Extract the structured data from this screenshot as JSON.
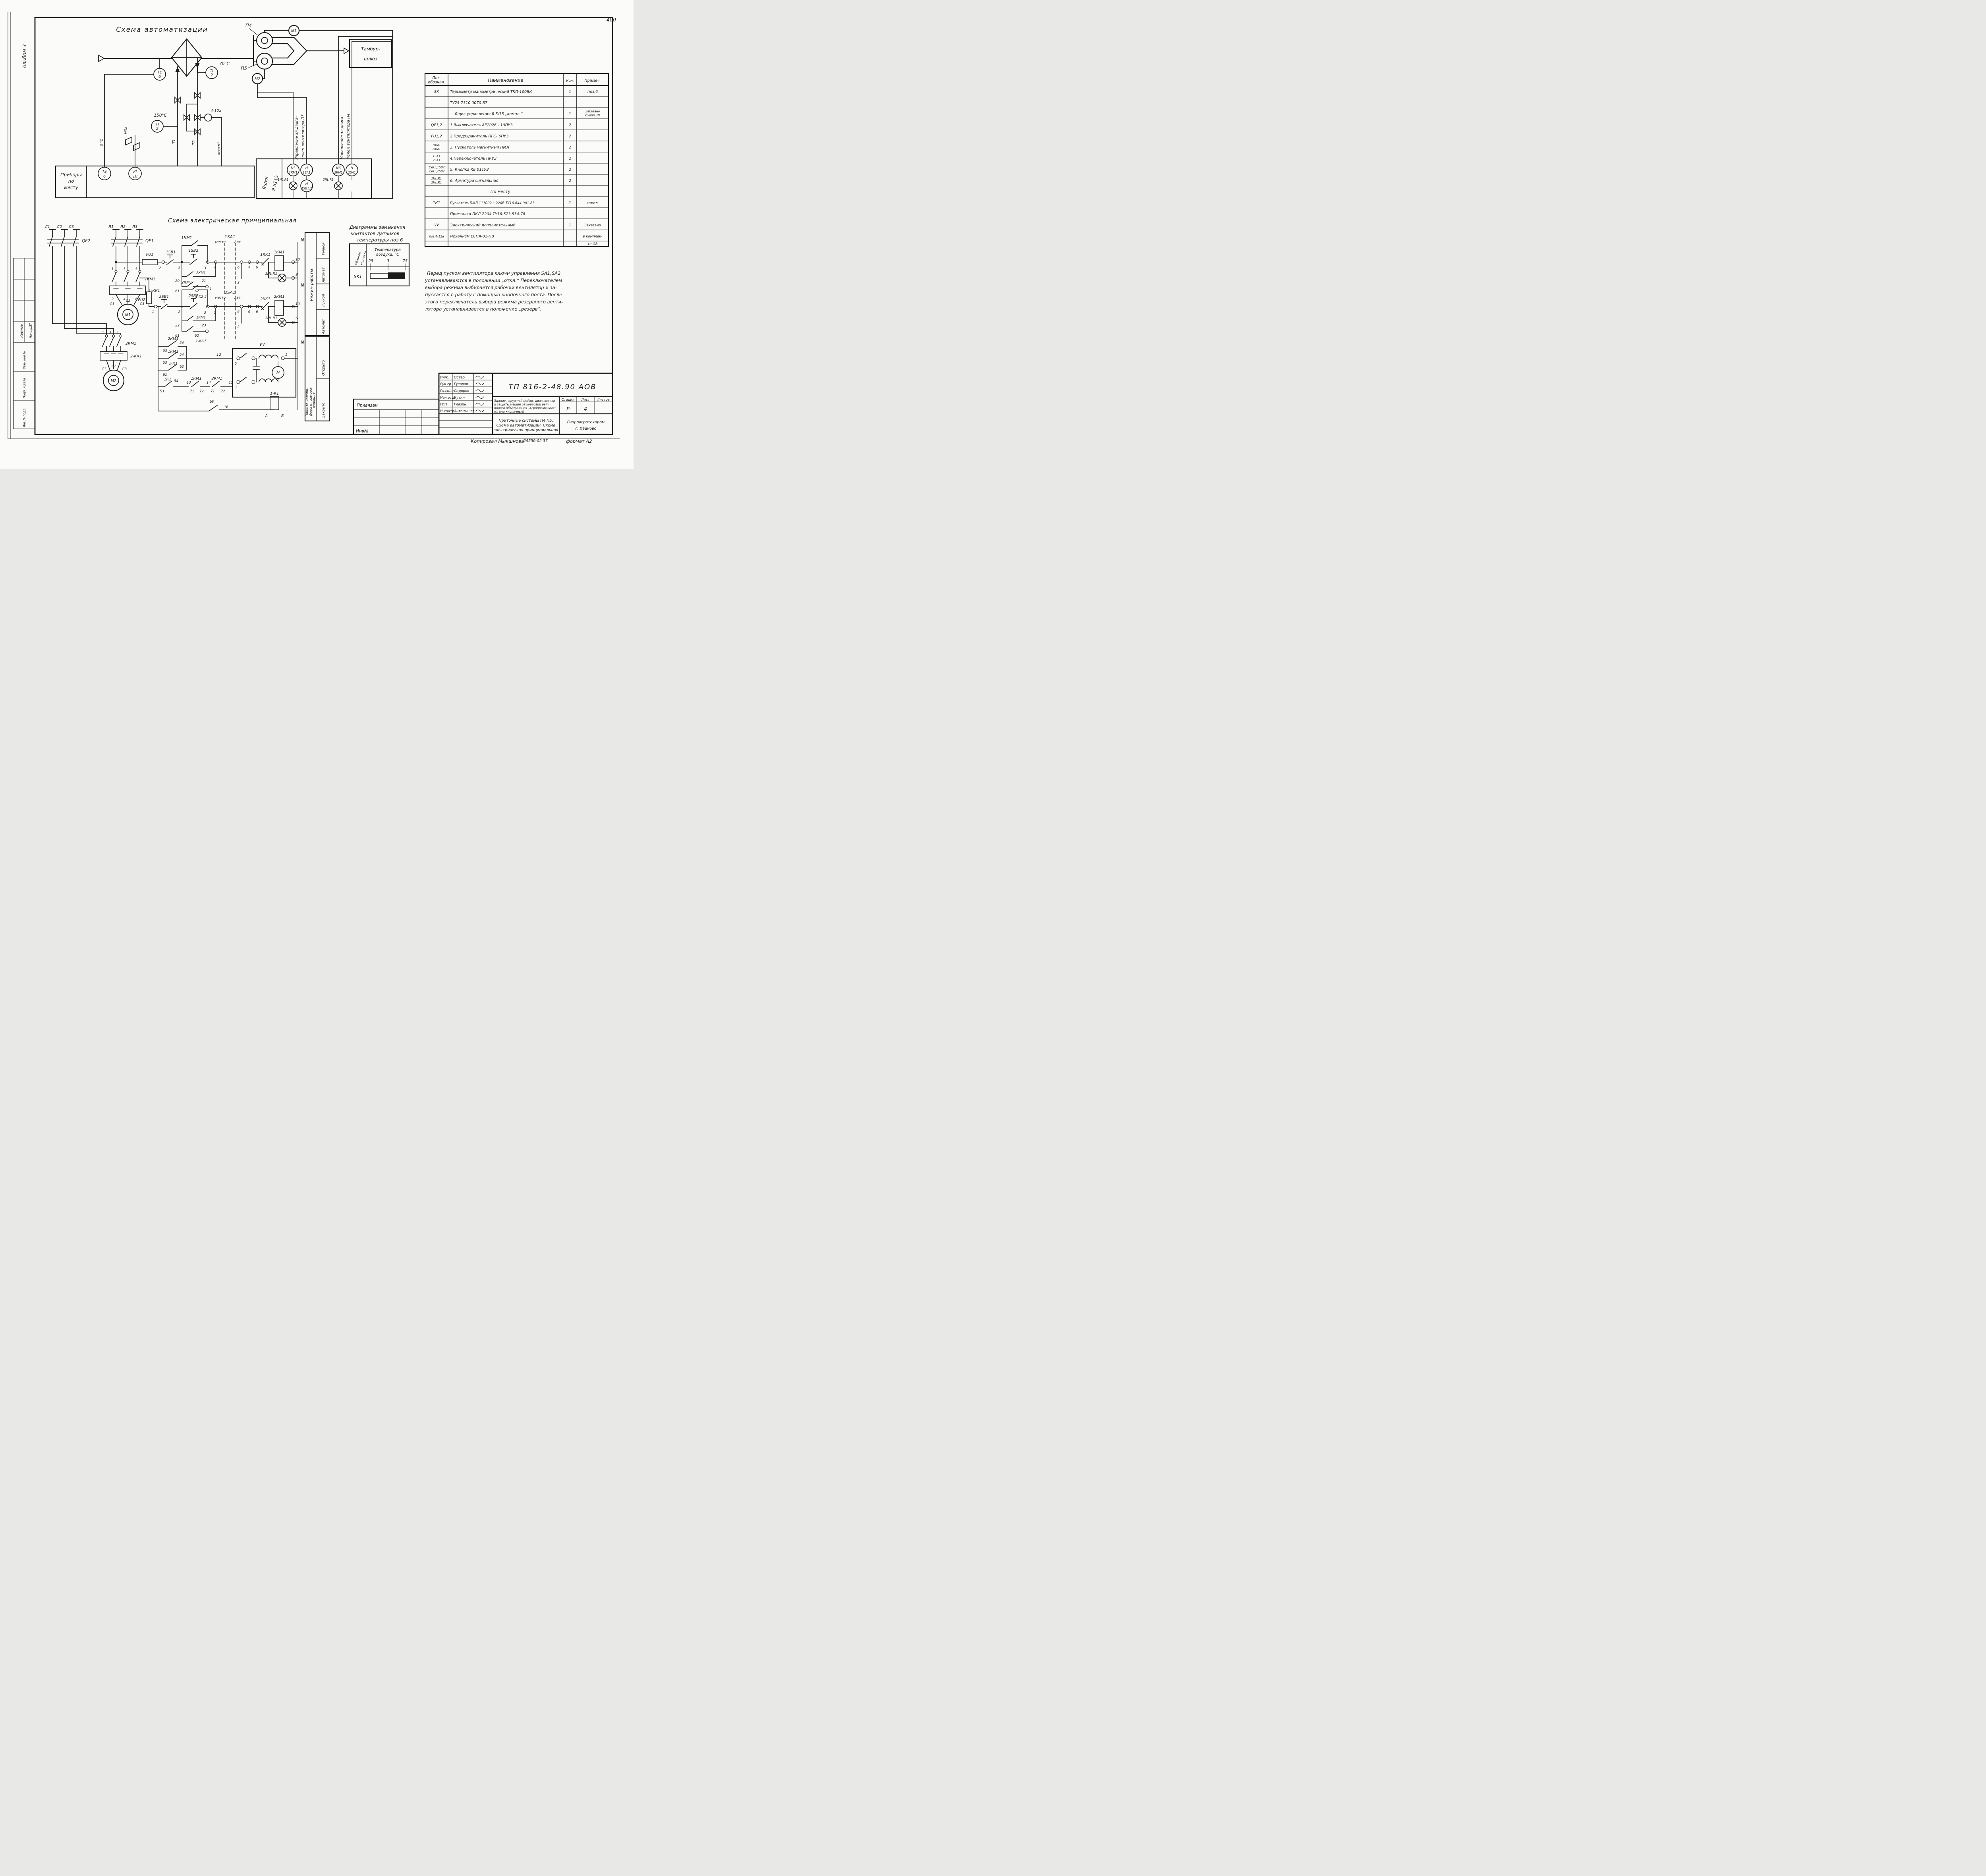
{
  "corner_mark": "400",
  "margin": {
    "album": "Альбом 3",
    "role": "Нач.пр.ЗТ",
    "sign": "Крылов",
    "rows": [
      "Взам.инв.№",
      "Подп. и дата",
      "Инв.№ подл."
    ]
  },
  "auto": {
    "title": "Схема автоматизации",
    "p4": "П4",
    "p5": "П5",
    "m1": "М1",
    "m2": "М2",
    "tambur1": "Тамбур-",
    "tambur2": "шлюз",
    "te": "ТЕ",
    "te_n": "6",
    "ti": "ТI",
    "ti_n": "2",
    "t70": "70°С",
    "t150": "150°С",
    "act": "4-12а",
    "t1": "Т1",
    "t2": "Т2",
    "mpa": "МПа",
    "kgs": "кгс/см²",
    "deg": "3 °С",
    "prib1": "Приборы",
    "prib2": "по",
    "prib3": "месту",
    "box1": "Ящик",
    "box2": "Я 5115",
    "ts": "ТS",
    "ts_n": "6",
    "pi": "РI",
    "pi_n": "10",
    "ns": "NS",
    "h": "Н",
    "km1": "1КМ1",
    "sa1": "1SA1",
    "hl1": "1HL.R1",
    "sb1": "1SB1,2",
    "km2": "2КМ1",
    "sa2": "2SA1",
    "hl2": "2HL.R1",
    "sb2": "2SB1,2",
    "upr1a": "Управление эл.двига-",
    "upr1b": "телем вентилятора П5",
    "upr2a": "Управление эл.двига-",
    "upr2b": "телем вентилятора П4"
  },
  "elec": {
    "title": "Схема электрическая принципиальная",
    "l1": "Л1",
    "l2": "Л2",
    "l3": "Л3",
    "qf1": "QF1",
    "qf2": "QF2",
    "fu1": "FU1",
    "fu2": "FU2",
    "km1": "1КМ1",
    "km2": "2КМ1",
    "kk1": "1-КК1",
    "kk2": "2-КК1",
    "kk1c": "1КК1",
    "kk2c": "2КК1",
    "c1": "С1",
    "c2": "С2",
    "c3": "С3",
    "m1": "М1",
    "m2": "М2",
    "m": "М",
    "sb11": "1SB1",
    "sb12": "1SB2",
    "sb21": "2SB1",
    "sb22": "2SB2",
    "sa1": "1SA1",
    "sa2": "2SA1",
    "mesto": "место",
    "avt": "Авт.",
    "hl1": "1HL.R1",
    "hl2": "2HL.R1",
    "n": "N",
    "x1": "1-Х2-5",
    "x2": "2-Х2-5",
    "k1": "1К1",
    "k11": "1-К1",
    "uu": "УУ",
    "sk": "SK",
    "a": "А",
    "b": "В",
    "t": {
      "1": "1",
      "2": "2",
      "3": "3",
      "4": "4",
      "5": "5",
      "6": "6",
      "9": "9",
      "10": "10",
      "12": "12",
      "13": "13",
      "14": "14",
      "15": "15",
      "16": "16",
      "20": "20",
      "21": "21",
      "22": "22",
      "23": "23",
      "53": "53",
      "54": "54",
      "61": "61",
      "62": "62",
      "71": "71",
      "72": "72"
    }
  },
  "mode": {
    "title": "Режим работы",
    "c1": "Ручной",
    "c2": "Автомат",
    "c3": "Ручной",
    "c4": "Автомат"
  },
  "prot": {
    "t1": "Защита калори-",
    "t2": "фера от замора-",
    "t3": "живания",
    "c1": "Открыто",
    "c2": "Закрыто"
  },
  "diag": {
    "t1": "Диаграммы замыкания",
    "t2": "контактов датчиков",
    "t3": "температуры поз.6",
    "h1a": "Обознач.",
    "h1b": "контакта",
    "h2a": "Температура",
    "h2b": "воздуха, °С",
    "tick1": "-25",
    "tick2": "3",
    "tick3": "75",
    "row": "SK1"
  },
  "parts": {
    "h_pos1": "Поз.",
    "h_pos2": "обознач.",
    "h_name": "Наименование",
    "h_qty": "Кол.",
    "h_note": "Примеч.",
    "r1": {
      "pos": "SK",
      "name": "Термометр манометрический ТКП-100ЭК",
      "qty": "1",
      "note": "поз.6"
    },
    "r2": {
      "name": "ТУ25-7310.0070-87"
    },
    "r3": {
      "name": "Ящик управления  Я 5/15   „компл.“",
      "qty": "1",
      "note1": "Заказано",
      "note2": "компл.ЭМ"
    },
    "r4": {
      "pos": "QF1,2",
      "name": "1.Выключатель  АЕ2026 - 10ПУЗ",
      "qty": "2"
    },
    "r5": {
      "pos": "FU1,2",
      "name": "2.Предохранитель ПРС- 6ПУЗ",
      "qty": "2"
    },
    "r6": {
      "pos1": "1КМ1",
      "pos2": "2КМ1",
      "name": "3. Пускатель магнитный  ПМЛ",
      "qty": "2"
    },
    "r7": {
      "pos1": "1SA1",
      "pos2": "2SA1",
      "name": "4.Переключатель  ПКУЗ",
      "qty": "2"
    },
    "r8": {
      "pos1": "1SB1,1SB2",
      "pos2": "2SB1,2SB2",
      "name": "5. Кнопка  КЕ 011УЗ",
      "qty": "2"
    },
    "r9": {
      "pos1": "1HL,R1",
      "pos2": "2HL,R1",
      "name": "6. Арматура сигнальная",
      "qty": "2"
    },
    "r10": {
      "name": "По месту"
    },
    "r11": {
      "pos": "1К1",
      "name": "Пускатель ПМЛ 111002 ~220В ТУ16-644.001-83",
      "qty": "1",
      "note": "компл."
    },
    "r12": {
      "name": "Приставка ПКЛ 2204  ТУ16-523.554-78"
    },
    "r13": {
      "pos": "УУ",
      "name": "Электрический исполнительный",
      "qty": "1",
      "note": "Заказано"
    },
    "r14": {
      "pos": "поз.4-12а",
      "name": "механизм  ЕСПА-02-ПВ",
      "note": "в комплек-"
    },
    "r15": {
      "note": "те ОВ"
    }
  },
  "notes": {
    "l1": "Перед пуском вентилятора ключи управления SA1,SA2",
    "l2": "устанавливаются в положении „откл.“ Переключателем",
    "l3": "выбора режима выбирается рабочий вентилятор и за-",
    "l4": "пускается в работу с помощью кнопочного поста. После",
    "l5": "этого переключатель выбора режима резервного венти-",
    "l6": "лятора устанавливается в положение „резерв“."
  },
  "tb": {
    "privyazan": "Привязан",
    "inv": "Инв№",
    "r1l": "Инж.",
    "r1n": "Остер",
    "r2l": "Рук.гр.",
    "r2n": "Гусаров",
    "r3l": "Гл.спец.",
    "r3n": "Сидоров",
    "r4l": "Нач.отд.",
    "r4n": "Кутин",
    "r5l": "ГИП",
    "r5n": "Глезин",
    "r6l": "Н.контр.",
    "r6n": "Антонышев",
    "doc": "ТП 816-2-48.90 АОВ",
    "obj1": "Здание наружной мойки, диагностики",
    "obj2": "и защиты машин от коррозии рай-",
    "obj3": "онного объединения „Агропромхимия“",
    "obj4": "(стены кирпичные)",
    "h_stage": "Стадия",
    "h_sheet": "Лист",
    "h_sheets": "Листов",
    "stage": "Р",
    "sheet": "4",
    "sub1": "Приточные системы П4,П5.",
    "sub2": "Схема автоматизации. Схема",
    "sub3": "электрическая принципиальная",
    "org1": "Гипроагротехпром",
    "org2": "г. Иваново"
  },
  "footer": {
    "copied": "Копировал Мыкшнова",
    "num": "24550-02  37",
    "fmt": "формат А2"
  }
}
